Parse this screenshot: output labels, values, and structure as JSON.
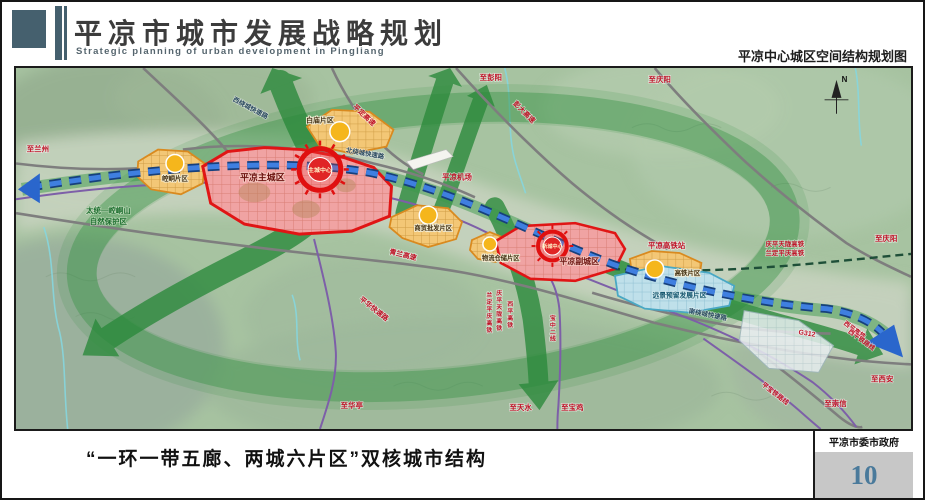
{
  "header": {
    "title_cn": "平凉市城市发展战略规划",
    "title_en": "Strategic planning of urban development in Pingliang",
    "subtitle_right": "平凉中心城区空间结构规划图"
  },
  "map": {
    "districts": {
      "main_city": "平凉主城区",
      "main_center": "主城中心",
      "sub_city": "平凉副城区",
      "sub_center": "新城中心",
      "kongtong": "崆峒片区",
      "baimiao": "白庙片区",
      "trade": "商贸批发片区",
      "logistics": "物流仓储片区",
      "hsr": "高铁片区",
      "reserve": "远景预留发展片区"
    },
    "places": {
      "nature_reserve_line1": "太统—崆峒山",
      "nature_reserve_line2": "自然保护区",
      "airport": "平凉机场",
      "hsr_station": "平凉高铁站"
    },
    "roads": {
      "west_ring": "西绕城快速路",
      "north_ring": "北绕城快速路",
      "south_ring": "南绕城快速路",
      "pingding_expwy": "平定高速",
      "pengda_expwy": "彭大高速",
      "qinglan_expwy": "青兰高速",
      "pinghua_expwy": "平华快速路",
      "g312": "G312",
      "qptl_hsr": "庆平天陇高铁",
      "ldpq_hsr": "兰定平庆高铁",
      "xiping_hsr": "西平高铁",
      "xiping_rail": "西平铁路线",
      "pingbao_rail": "平宝铁路线",
      "baozhong_line2": "宝中二线"
    },
    "destinations": {
      "lanzhou": "至兰州",
      "pengyang": "至彭阳",
      "qingyang": "至庆阳",
      "xian": "至西安",
      "chongxin": "至崇信",
      "huating": "至华亭",
      "tianshui": "至天水",
      "baoji": "至宝鸡"
    },
    "compass": "N"
  },
  "footer": {
    "caption": "“一环一带五廊、两城六片区”双核城市结构",
    "agency": "平凉市委市政府",
    "page_number": "10"
  },
  "colors": {
    "corridor_green": "#2c8a3c",
    "river_blue": "#2a66cc",
    "city_red": "#e01515",
    "district_orange": "#d98a1f",
    "page_number_blue": "#4a7a9b"
  }
}
